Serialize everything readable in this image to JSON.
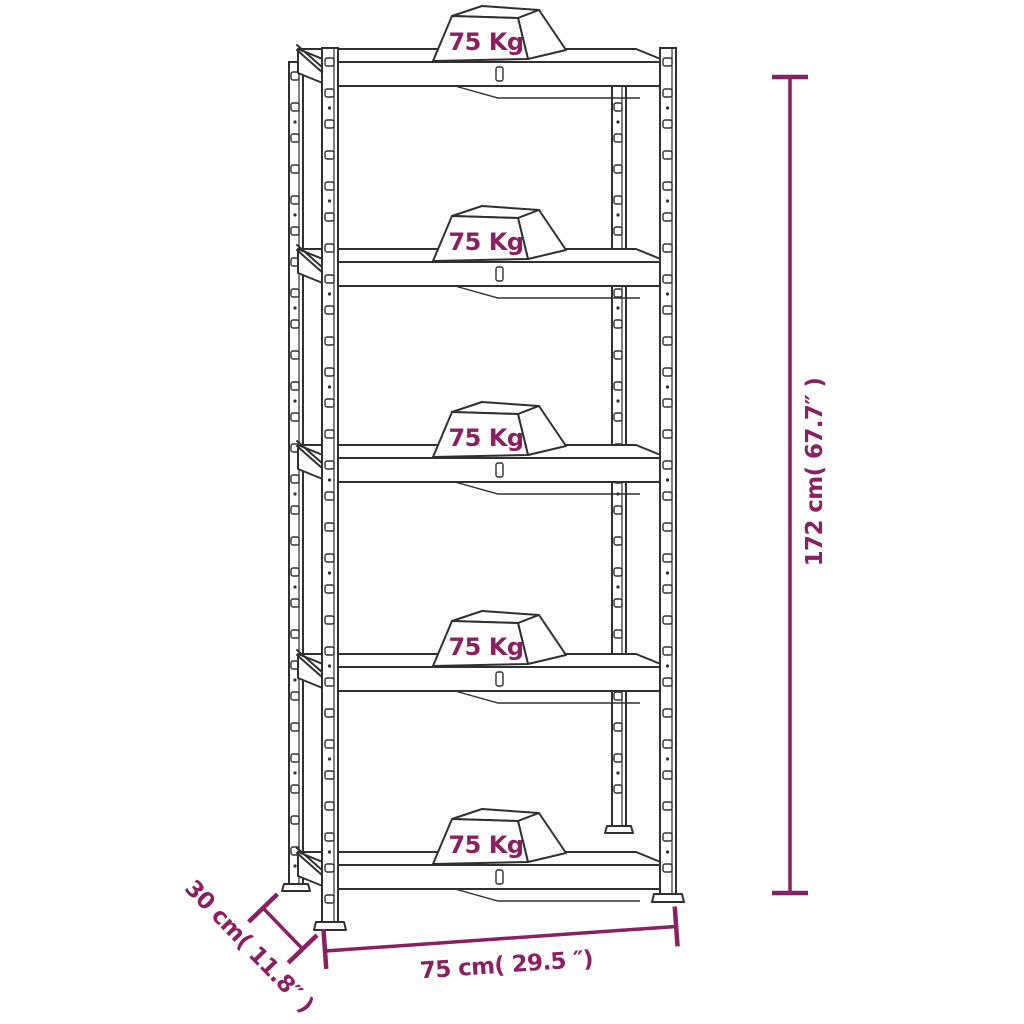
{
  "diagram": {
    "shelves": [
      {
        "load_label": "75 Kg"
      },
      {
        "load_label": "75 Kg"
      },
      {
        "load_label": "75 Kg"
      },
      {
        "load_label": "75 Kg"
      },
      {
        "load_label": "75 Kg"
      }
    ],
    "dimensions": {
      "height_label": "172 cm( 67.7″ )",
      "width_label": "75 cm( 29.5 ″)",
      "depth_label": "30 cm( 11.8″ )"
    },
    "colors": {
      "dimension_accent": "#8A1F63",
      "line": "#303030",
      "background": "#FFFFFF"
    }
  }
}
